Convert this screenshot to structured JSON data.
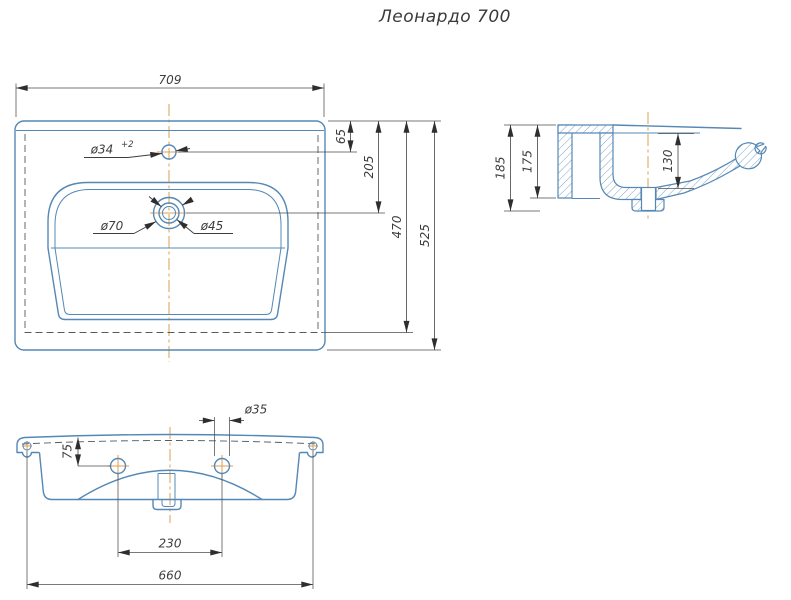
{
  "title": "Леонардо 700",
  "colors": {
    "object_line": "#5588b4",
    "dimension_line": "#4d4d4d",
    "centerline": "#dc9f55",
    "background": "#ffffff"
  },
  "top_view": {
    "dim_overall_width": "709",
    "dim_faucet_offset": "65",
    "dim_drain_offset": "205",
    "dim_inner_depth": "470",
    "dim_overall_depth": "525",
    "label_faucet_hole": "ø34",
    "label_faucet_tolerance": "+2",
    "label_drain_outer": "ø70",
    "label_drain_inner": "ø45"
  },
  "side_view": {
    "dim_overall_height": "185",
    "dim_back_height": "175",
    "dim_bowl_depth": "130"
  },
  "front_view": {
    "dim_hole_diameter": "ø35",
    "dim_hole_offset": "75",
    "dim_hole_spacing": "230",
    "dim_mounting_width": "660"
  }
}
